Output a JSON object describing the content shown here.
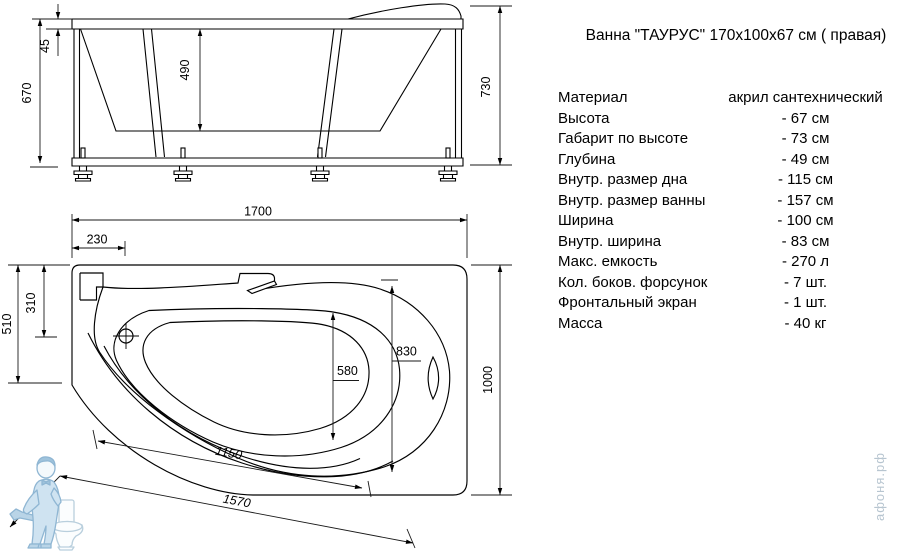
{
  "title": "Ванна \"ТАУРУС\" 170x100x67 см ( правая)",
  "specs": {
    "rows": [
      {
        "label": "Материал",
        "value": "акрил сантехнический"
      },
      {
        "label": "Высота",
        "value": "- 67 см"
      },
      {
        "label": "Габарит по высоте",
        "value": "- 73 см"
      },
      {
        "label": "Глубина",
        "value": "- 49 см"
      },
      {
        "label": "Внутр. размер дна",
        "value": "- 115 см"
      },
      {
        "label": "Внутр. размер ванны",
        "value": "- 157 см"
      },
      {
        "label": "Ширина",
        "value": "- 100 см"
      },
      {
        "label": "Внутр. ширина",
        "value": "- 83 см"
      },
      {
        "label": "Макс. емкость",
        "value": "- 270 л"
      },
      {
        "label": "Кол. боков. форсунок",
        "value": "- 7 шт."
      },
      {
        "label": "Фронтальный экран",
        "value": "- 1 шт."
      },
      {
        "label": "Масса",
        "value": "- 40 кг"
      }
    ]
  },
  "side_view": {
    "dims": {
      "rim_height": "45",
      "inner_depth": "490",
      "height": "670",
      "overall_height": "730"
    }
  },
  "plan_view": {
    "dims": {
      "length": "1700",
      "head_offset": "230",
      "left_width": "510",
      "drain_offset": "310",
      "bottom_width": "580",
      "inner_width": "830",
      "width": "1000",
      "bottom_length": "1150",
      "inner_length": "1570"
    }
  },
  "watermark": {
    "brand": "афоня.рф"
  },
  "colors": {
    "line": "#000000",
    "watermark_fill": "#cfe3f1",
    "watermark_stroke": "#8fb6d3",
    "brand_text": "#b7c5d0"
  }
}
